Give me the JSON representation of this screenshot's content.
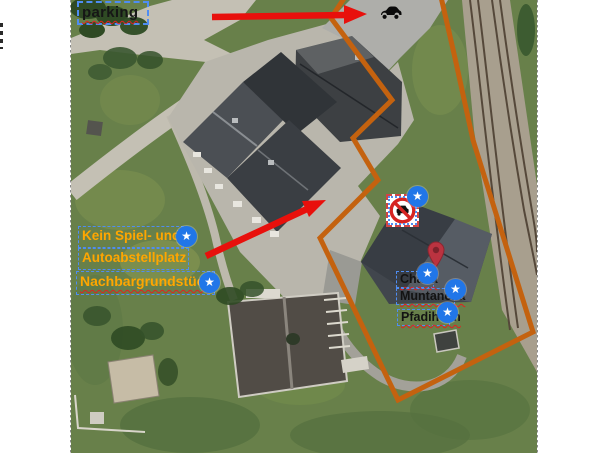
{
  "app": {
    "type": "aerial-map-annotation"
  },
  "annotations": {
    "parking_label": "parking",
    "rule_label_line1": "Kein Spiel- und",
    "rule_label_line2": "Autoabstellplatz",
    "neighbor_label": "Nachbargrundstück",
    "house_label_line1": "Chasa",
    "house_label_line2": "Muntanella",
    "scout_home_label": "Pfadiheim"
  },
  "markers": {
    "star_icon": "★",
    "star_count": 6,
    "pin_icon": "location-pin",
    "sign_icon": "no-parking-sign",
    "car_icon": "car"
  },
  "colors": {
    "boundary_orange": "#c4620f",
    "arrow_red": "#e8100c",
    "label_orange": "#ffa600",
    "label_black": "#131313",
    "marker_blue": "#2176e8",
    "selection_blue": "#4f8df2",
    "spellcheck_red": "#e02020",
    "pin_red": "#bb3340",
    "sign_red": "#d62422"
  }
}
